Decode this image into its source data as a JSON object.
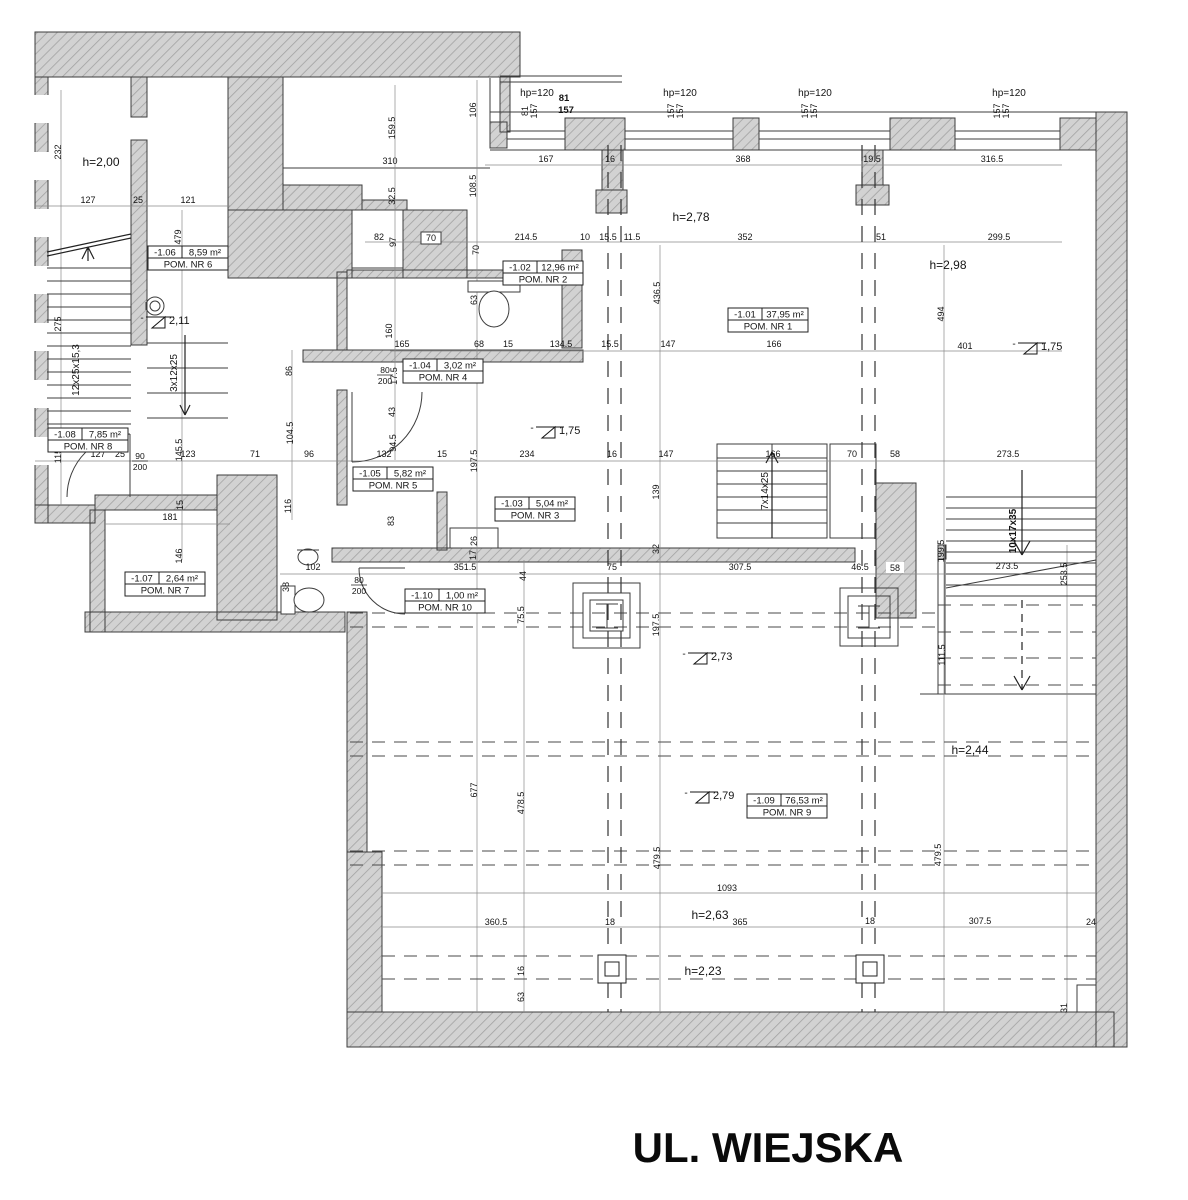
{
  "street_label": "UL. WIEJSKA",
  "colors": {
    "wall_fill": "#d2d2d2",
    "wall_hatch": "#a2a2a2",
    "wall_stroke": "#3c3c3c",
    "dim_line": "#8a8a8a",
    "text": "#141414"
  },
  "rooms": [
    {
      "num": "-1.06",
      "area": "8,59 m²",
      "name": "POM. NR 6",
      "x": 148,
      "y": 246
    },
    {
      "num": "-1.02",
      "area": "12,96 m²",
      "name": "POM. NR 2",
      "x": 503,
      "y": 261
    },
    {
      "num": "-1.01",
      "area": "37,95 m²",
      "name": "POM. NR 1",
      "x": 728,
      "y": 308
    },
    {
      "num": "-1.04",
      "area": "3,02 m²",
      "name": "POM. NR 4",
      "x": 403,
      "y": 359
    },
    {
      "num": "-1.08",
      "area": "7,85 m²",
      "name": "POM. NR 8",
      "x": 48,
      "y": 428
    },
    {
      "num": "-1.05",
      "area": "5,82 m²",
      "name": "POM. NR 5",
      "x": 353,
      "y": 467
    },
    {
      "num": "-1.03",
      "area": "5,04 m²",
      "name": "POM. NR 3",
      "x": 495,
      "y": 497
    },
    {
      "num": "-1.07",
      "area": "2,64 m²",
      "name": "POM. NR 7",
      "x": 125,
      "y": 572
    },
    {
      "num": "-1.10",
      "area": "1,00 m²",
      "name": "POM. NR 10",
      "x": 405,
      "y": 589
    },
    {
      "num": "-1.09",
      "area": "76,53 m²",
      "name": "POM. NR 9",
      "x": 747,
      "y": 794
    }
  ],
  "heights": [
    {
      "t": "h=2,00",
      "x": 101,
      "y": 166
    },
    {
      "t": "h=2,78",
      "x": 691,
      "y": 221
    },
    {
      "t": "h=2,98",
      "x": 948,
      "y": 269
    },
    {
      "t": "h=2,44",
      "x": 970,
      "y": 754
    },
    {
      "t": "h=2,63",
      "x": 710,
      "y": 919
    },
    {
      "t": "h=2,23",
      "x": 703,
      "y": 975
    }
  ],
  "levels": [
    {
      "t": "2,11",
      "x": 152,
      "y": 322
    },
    {
      "t": "1,75",
      "x": 1024,
      "y": 348
    },
    {
      "t": "1,75",
      "x": 542,
      "y": 432
    },
    {
      "t": "2,73",
      "x": 694,
      "y": 658
    },
    {
      "t": "2,79",
      "x": 696,
      "y": 797
    }
  ],
  "window_heads": [
    {
      "t": "hp=120",
      "x": 537,
      "y": 96
    },
    {
      "t": "hp=120",
      "x": 680,
      "y": 96
    },
    {
      "t": "hp=120",
      "x": 815,
      "y": 96
    },
    {
      "t": "hp=120",
      "x": 1009,
      "y": 96
    }
  ],
  "bold_marks": [
    {
      "t": "81",
      "x": 564,
      "y": 101
    },
    {
      "t": "157",
      "x": 566,
      "y": 113
    }
  ],
  "stair_labels": [
    {
      "t": "12x25x15,3",
      "x": 79,
      "y": 370,
      "bold": false
    },
    {
      "t": "3x12x25",
      "x": 177,
      "y": 373,
      "bold": false
    },
    {
      "t": "7x14x25",
      "x": 768,
      "y": 491,
      "bold": false
    },
    {
      "t": "10x17x35",
      "x": 1016,
      "y": 531,
      "bold": true
    }
  ],
  "door_sizes": [
    {
      "top": "80",
      "bottom": "200",
      "x": 385,
      "y": 374
    },
    {
      "top": "90",
      "bottom": "200",
      "x": 140,
      "y": 460
    },
    {
      "top": "80",
      "bottom": "200",
      "x": 359,
      "y": 584
    }
  ],
  "dims_h": [
    {
      "t": "127",
      "x": 88,
      "y": 203
    },
    {
      "t": "25",
      "x": 138,
      "y": 203
    },
    {
      "t": "121",
      "x": 188,
      "y": 203
    },
    {
      "t": "310",
      "x": 390,
      "y": 164
    },
    {
      "t": "167",
      "x": 546,
      "y": 162
    },
    {
      "t": "16",
      "x": 610,
      "y": 162
    },
    {
      "t": "368",
      "x": 743,
      "y": 162
    },
    {
      "t": "19.5",
      "x": 872,
      "y": 162
    },
    {
      "t": "316.5",
      "x": 992,
      "y": 162
    },
    {
      "t": "214.5",
      "x": 526,
      "y": 240
    },
    {
      "t": "10",
      "x": 585,
      "y": 240
    },
    {
      "t": "15.5",
      "x": 608,
      "y": 240
    },
    {
      "t": "11.5",
      "x": 632,
      "y": 240
    },
    {
      "t": "352",
      "x": 745,
      "y": 240
    },
    {
      "t": "51",
      "x": 881,
      "y": 240
    },
    {
      "t": "299.5",
      "x": 999,
      "y": 240
    },
    {
      "t": "82",
      "x": 379,
      "y": 240
    },
    {
      "t": "70",
      "x": 431,
      "y": 241,
      "box": 1
    },
    {
      "t": "165",
      "x": 402,
      "y": 347
    },
    {
      "t": "68",
      "x": 479,
      "y": 347
    },
    {
      "t": "15",
      "x": 508,
      "y": 347
    },
    {
      "t": "134.5",
      "x": 561,
      "y": 347
    },
    {
      "t": "15.5",
      "x": 610,
      "y": 347
    },
    {
      "t": "147",
      "x": 668,
      "y": 347
    },
    {
      "t": "166",
      "x": 774,
      "y": 347
    },
    {
      "t": "401",
      "x": 965,
      "y": 349
    },
    {
      "t": "127",
      "x": 98,
      "y": 457
    },
    {
      "t": "25",
      "x": 120,
      "y": 457
    },
    {
      "t": "123",
      "x": 188,
      "y": 457
    },
    {
      "t": "71",
      "x": 255,
      "y": 457
    },
    {
      "t": "96",
      "x": 309,
      "y": 457
    },
    {
      "t": "132",
      "x": 384,
      "y": 457
    },
    {
      "t": "15",
      "x": 442,
      "y": 457
    },
    {
      "t": "234",
      "x": 527,
      "y": 457
    },
    {
      "t": "16",
      "x": 612,
      "y": 457
    },
    {
      "t": "147",
      "x": 666,
      "y": 457
    },
    {
      "t": "166",
      "x": 773,
      "y": 457
    },
    {
      "t": "70",
      "x": 852,
      "y": 457
    },
    {
      "t": "58",
      "x": 895,
      "y": 457
    },
    {
      "t": "273.5",
      "x": 1008,
      "y": 457
    },
    {
      "t": "181",
      "x": 170,
      "y": 520
    },
    {
      "t": "102",
      "x": 313,
      "y": 570
    },
    {
      "t": "351.5",
      "x": 465,
      "y": 570
    },
    {
      "t": "75",
      "x": 612,
      "y": 570
    },
    {
      "t": "307.5",
      "x": 740,
      "y": 570
    },
    {
      "t": "46.5",
      "x": 860,
      "y": 570
    },
    {
      "t": "58",
      "x": 895,
      "y": 571,
      "wbox": 1
    },
    {
      "t": "273.5",
      "x": 1007,
      "y": 569
    },
    {
      "t": "1093",
      "x": 727,
      "y": 891
    },
    {
      "t": "360.5",
      "x": 496,
      "y": 925
    },
    {
      "t": "18",
      "x": 610,
      "y": 925
    },
    {
      "t": "365",
      "x": 740,
      "y": 925
    },
    {
      "t": "18",
      "x": 870,
      "y": 924
    },
    {
      "t": "307.5",
      "x": 980,
      "y": 924
    },
    {
      "t": "24",
      "x": 1091,
      "y": 925
    }
  ],
  "dims_rot": [
    {
      "t": "232",
      "x": 61,
      "y": 152
    },
    {
      "t": "275",
      "x": 61,
      "y": 324
    },
    {
      "t": "479",
      "x": 181,
      "y": 237
    },
    {
      "t": "159.5",
      "x": 395,
      "y": 128
    },
    {
      "t": "32.5",
      "x": 395,
      "y": 196
    },
    {
      "t": "106",
      "x": 476,
      "y": 110
    },
    {
      "t": "108.5",
      "x": 476,
      "y": 186
    },
    {
      "t": "97",
      "x": 396,
      "y": 242
    },
    {
      "t": "70",
      "x": 479,
      "y": 250
    },
    {
      "t": "63",
      "x": 477,
      "y": 300
    },
    {
      "t": "160",
      "x": 392,
      "y": 331
    },
    {
      "t": "436.5",
      "x": 660,
      "y": 293
    },
    {
      "t": "494",
      "x": 944,
      "y": 314
    },
    {
      "t": "86",
      "x": 292,
      "y": 371
    },
    {
      "t": "17.5",
      "x": 397,
      "y": 376
    },
    {
      "t": "43",
      "x": 395,
      "y": 412
    },
    {
      "t": "94.5",
      "x": 396,
      "y": 443
    },
    {
      "t": "104.5",
      "x": 293,
      "y": 433
    },
    {
      "t": "145.5",
      "x": 182,
      "y": 450
    },
    {
      "t": "115",
      "x": 61,
      "y": 456
    },
    {
      "t": "116",
      "x": 291,
      "y": 506
    },
    {
      "t": "15",
      "x": 183,
      "y": 505
    },
    {
      "t": "146",
      "x": 182,
      "y": 556
    },
    {
      "t": "83",
      "x": 394,
      "y": 521
    },
    {
      "t": "197.5",
      "x": 477,
      "y": 461
    },
    {
      "t": "139",
      "x": 659,
      "y": 492
    },
    {
      "t": "26",
      "x": 477,
      "y": 541
    },
    {
      "t": "17",
      "x": 476,
      "y": 555
    },
    {
      "t": "32",
      "x": 659,
      "y": 549
    },
    {
      "t": "38",
      "x": 289,
      "y": 587
    },
    {
      "t": "44",
      "x": 526,
      "y": 576
    },
    {
      "t": "75.5",
      "x": 524,
      "y": 615
    },
    {
      "t": "197.5",
      "x": 659,
      "y": 625
    },
    {
      "t": "199.5",
      "x": 944,
      "y": 551
    },
    {
      "t": "253.5",
      "x": 1067,
      "y": 574
    },
    {
      "t": "111.5",
      "x": 945,
      "y": 655
    },
    {
      "t": "677",
      "x": 477,
      "y": 790
    },
    {
      "t": "478.5",
      "x": 524,
      "y": 803
    },
    {
      "t": "479.5",
      "x": 660,
      "y": 858
    },
    {
      "t": "479.5",
      "x": 941,
      "y": 855
    },
    {
      "t": "16",
      "x": 524,
      "y": 971
    },
    {
      "t": "63",
      "x": 524,
      "y": 997
    },
    {
      "t": "31",
      "x": 1067,
      "y": 1008
    },
    {
      "t": "81",
      "x": 528,
      "y": 111
    },
    {
      "t": "157",
      "x": 537,
      "y": 111
    },
    {
      "t": "157",
      "x": 674,
      "y": 111
    },
    {
      "t": "157",
      "x": 683,
      "y": 111
    },
    {
      "t": "157",
      "x": 808,
      "y": 111
    },
    {
      "t": "157",
      "x": 817,
      "y": 111
    },
    {
      "t": "157",
      "x": 1000,
      "y": 111
    },
    {
      "t": "157",
      "x": 1009,
      "y": 111
    }
  ]
}
